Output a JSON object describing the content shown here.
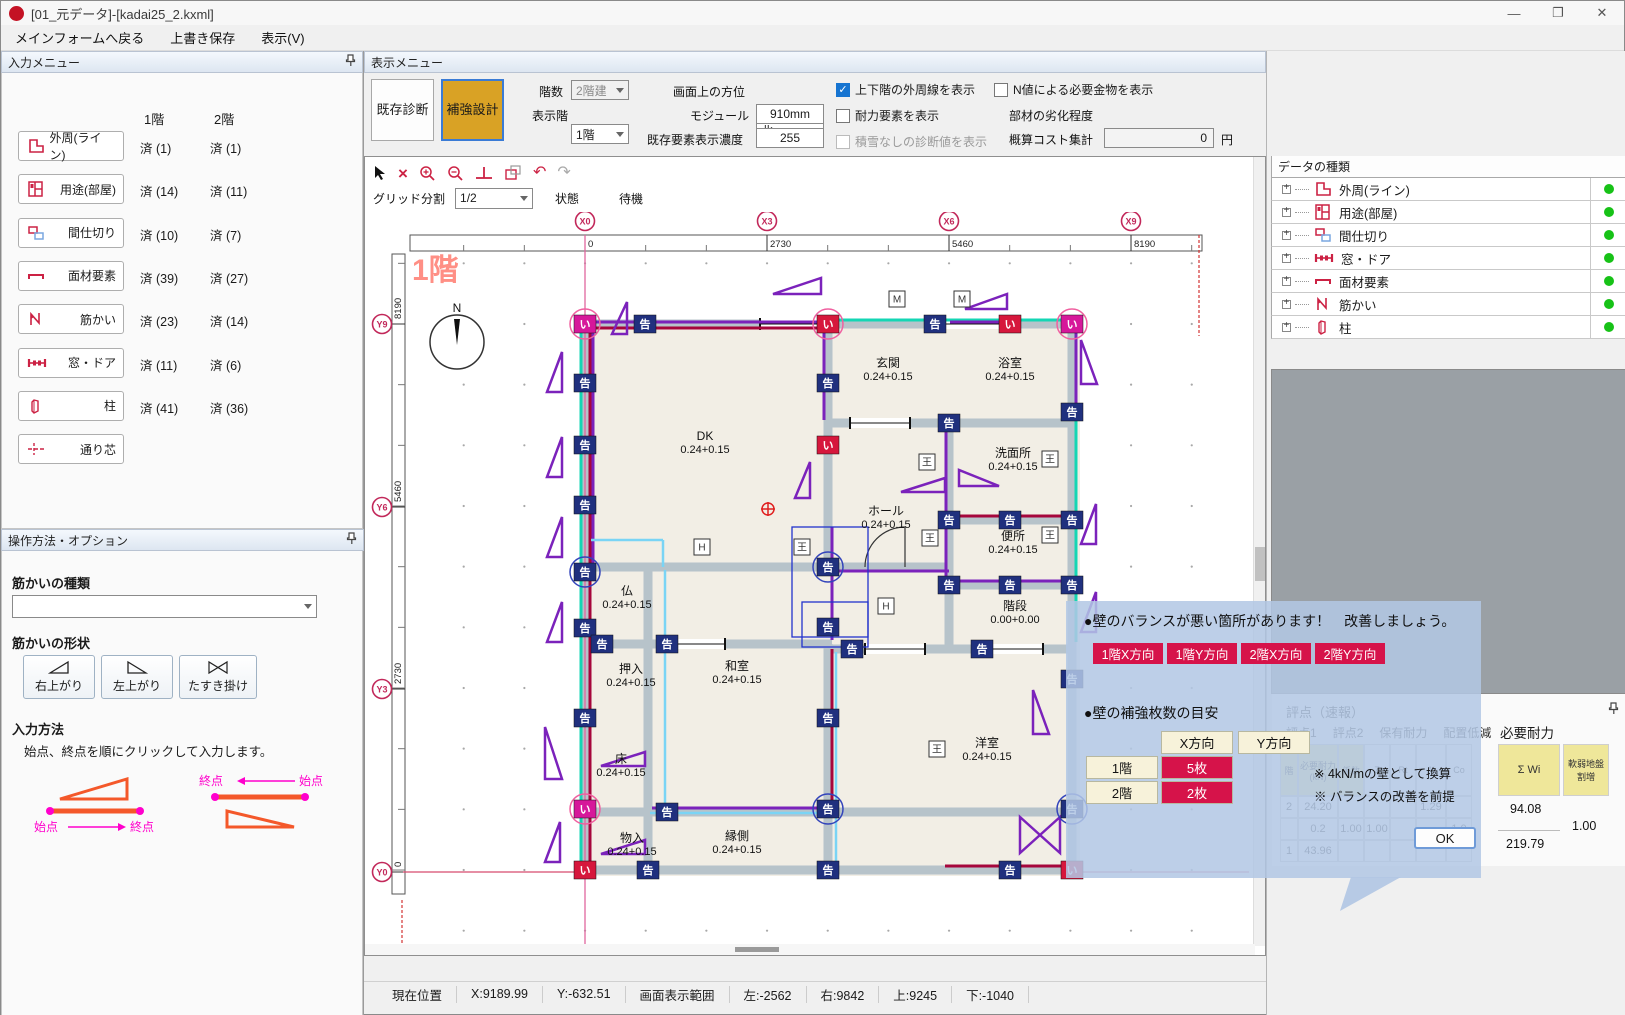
{
  "window": {
    "title": "[01_元データ]-[kadai25_2.kxml]",
    "minimize": "—",
    "maximize": "❐",
    "close": "✕"
  },
  "menu": {
    "items": [
      "メインフォームへ戻る",
      "上書き保存",
      "表示(V)"
    ]
  },
  "input_menu": {
    "title": "入力メニュー",
    "col1": "1階",
    "col2": "2階",
    "rows": [
      {
        "label": "外周(ライン)",
        "icon": "outline",
        "f1": "済 (1)",
        "f2": "済 (1)"
      },
      {
        "label": "用途(部屋)",
        "icon": "room",
        "f1": "済 (14)",
        "f2": "済 (11)"
      },
      {
        "label": "間仕切り",
        "icon": "partition",
        "f1": "済 (10)",
        "f2": "済 (7)"
      },
      {
        "label": "面材要素",
        "icon": "panel",
        "f1": "済 (39)",
        "f2": "済 (27)"
      },
      {
        "label": "筋かい",
        "icon": "brace",
        "f1": "済 (23)",
        "f2": "済 (14)"
      },
      {
        "label": "窓・ドア",
        "icon": "windoor",
        "f1": "済 (11)",
        "f2": "済 (6)"
      },
      {
        "label": "柱",
        "icon": "column",
        "f1": "済 (41)",
        "f2": "済 (36)"
      },
      {
        "label": "通り芯",
        "icon": "gridline",
        "f1": "",
        "f2": ""
      }
    ]
  },
  "options_panel": {
    "title": "操作方法・オプション",
    "type_label": "筋かいの種類",
    "shape_label": "筋かいの形状",
    "shapes": [
      "右上がり",
      "左上がり",
      "たすき掛け"
    ],
    "method_label": "入力方法",
    "method_text": "始点、終点を順にクリックして入力します。",
    "diag_start": "始点",
    "diag_end": "終点"
  },
  "display_menu": {
    "title": "表示メニュー",
    "buttons": [
      {
        "label": "既存診断"
      },
      {
        "label": "補強設計"
      }
    ],
    "floors_label": "階数",
    "floors_value": "2階建",
    "shown_floor_label": "表示階",
    "shown_floor_value": "1階",
    "direction_label": "画面上の方位",
    "direction_value": "北",
    "module_label": "モジュール",
    "module_value": "910mm",
    "density_label": "既存要素表示濃度",
    "density_value": "255",
    "checkboxes": [
      {
        "label": "上下階の外周線を表示",
        "checked": true,
        "disabled": false
      },
      {
        "label": "耐力要素を表示",
        "checked": false,
        "disabled": false
      },
      {
        "label": "積雪なしの診断値を表示",
        "checked": false,
        "disabled": true
      },
      {
        "label": "N値による必要金物を表示",
        "checked": false,
        "disabled": false
      }
    ],
    "degrade_label": "部材の劣化程度",
    "degrade_value": "①劣化が認められない",
    "cost_label": "概算コスト集計",
    "cost_value": "0",
    "cost_unit": "円"
  },
  "canvas": {
    "grid_label": "グリッド分割",
    "grid_value": "1/2",
    "state_label": "状態",
    "state_value": "待機",
    "floor_label": "1階",
    "compass": "N",
    "x_axis": [
      {
        "id": "X0",
        "v": "0",
        "p": 220
      },
      {
        "id": "X3",
        "v": "2730",
        "p": 402
      },
      {
        "id": "X6",
        "v": "5460",
        "p": 584
      },
      {
        "id": "X9",
        "v": "8190",
        "p": 766
      }
    ],
    "y_axis": [
      {
        "id": "Y9",
        "v": "8190",
        "p": 112
      },
      {
        "id": "Y6",
        "v": "5460",
        "p": 295
      },
      {
        "id": "Y3",
        "v": "2730",
        "p": 477
      },
      {
        "id": "Y0",
        "v": "0",
        "p": 660
      }
    ],
    "rooms": [
      {
        "n": "DK",
        "c": "0.24+0.15",
        "x": 340,
        "y": 228
      },
      {
        "n": "玄関",
        "c": "0.24+0.15",
        "x": 523,
        "y": 155
      },
      {
        "n": "浴室",
        "c": "0.24+0.15",
        "x": 645,
        "y": 155
      },
      {
        "n": "洗面所",
        "c": "0.24+0.15",
        "x": 648,
        "y": 245
      },
      {
        "n": "ホール",
        "c": "0.24+0.15",
        "x": 521,
        "y": 303
      },
      {
        "n": "便所",
        "c": "0.24+0.15",
        "x": 648,
        "y": 328
      },
      {
        "n": "階段",
        "c": "0.00+0.00",
        "x": 650,
        "y": 398
      },
      {
        "n": "仏",
        "c": "0.24+0.15",
        "x": 262,
        "y": 383
      },
      {
        "n": "押入",
        "c": "0.24+0.15",
        "x": 266,
        "y": 461
      },
      {
        "n": "和室",
        "c": "0.24+0.15",
        "x": 372,
        "y": 458
      },
      {
        "n": "床",
        "c": "0.24+0.15",
        "x": 256,
        "y": 551
      },
      {
        "n": "洋室",
        "c": "0.24+0.15",
        "x": 622,
        "y": 535
      },
      {
        "n": "物入",
        "c": "0.24+0.15",
        "x": 267,
        "y": 630
      },
      {
        "n": "縁側",
        "c": "0.24+0.15",
        "x": 372,
        "y": 628
      }
    ],
    "badges": [
      {
        "x": 220,
        "y": 112,
        "t": "い",
        "c": "#d6179a",
        "r": "pink"
      },
      {
        "x": 280,
        "y": 112,
        "t": "告"
      },
      {
        "x": 463,
        "y": 112,
        "t": "い",
        "c": "#d6173c",
        "r": "pink"
      },
      {
        "x": 570,
        "y": 112,
        "t": "告"
      },
      {
        "x": 645,
        "y": 112,
        "t": "い",
        "c": "#d6173c"
      },
      {
        "x": 707,
        "y": 112,
        "t": "い",
        "c": "#d6179a",
        "r": "pink"
      },
      {
        "x": 220,
        "y": 171,
        "t": "告"
      },
      {
        "x": 220,
        "y": 233,
        "t": "告"
      },
      {
        "x": 220,
        "y": 293,
        "t": "告"
      },
      {
        "x": 220,
        "y": 360,
        "t": "告",
        "r": "blue"
      },
      {
        "x": 220,
        "y": 416,
        "t": "告"
      },
      {
        "x": 220,
        "y": 506,
        "t": "告"
      },
      {
        "x": 220,
        "y": 597,
        "t": "い",
        "c": "#d6179a",
        "r": "pink"
      },
      {
        "x": 220,
        "y": 658,
        "t": "い",
        "c": "#d6173c"
      },
      {
        "x": 463,
        "y": 171,
        "t": "告"
      },
      {
        "x": 463,
        "y": 233,
        "t": "い",
        "c": "#d6173c"
      },
      {
        "x": 463,
        "y": 355,
        "t": "告",
        "r": "blue"
      },
      {
        "x": 463,
        "y": 415,
        "t": "告"
      },
      {
        "x": 463,
        "y": 506,
        "t": "告"
      },
      {
        "x": 463,
        "y": 597,
        "t": "告",
        "r": "blue"
      },
      {
        "x": 463,
        "y": 658,
        "t": "告"
      },
      {
        "x": 584,
        "y": 211,
        "t": "告"
      },
      {
        "x": 584,
        "y": 308,
        "t": "告"
      },
      {
        "x": 645,
        "y": 308,
        "t": "告"
      },
      {
        "x": 707,
        "y": 308,
        "t": "告"
      },
      {
        "x": 584,
        "y": 373,
        "t": "告"
      },
      {
        "x": 645,
        "y": 373,
        "t": "告"
      },
      {
        "x": 707,
        "y": 373,
        "t": "告"
      },
      {
        "x": 707,
        "y": 200,
        "t": "告"
      },
      {
        "x": 707,
        "y": 467,
        "t": "告"
      },
      {
        "x": 707,
        "y": 597,
        "t": "告",
        "r": "blue"
      },
      {
        "x": 237,
        "y": 432,
        "t": "告"
      },
      {
        "x": 302,
        "y": 432,
        "t": "告"
      },
      {
        "x": 487,
        "y": 437,
        "t": "告"
      },
      {
        "x": 617,
        "y": 437,
        "t": "告"
      },
      {
        "x": 302,
        "y": 600,
        "t": "告"
      },
      {
        "x": 283,
        "y": 658,
        "t": "告"
      },
      {
        "x": 645,
        "y": 658,
        "t": "告"
      },
      {
        "x": 707,
        "y": 658,
        "t": "い",
        "c": "#d6173c"
      }
    ],
    "boxes": [
      {
        "x": 532,
        "y": 87,
        "t": "M"
      },
      {
        "x": 597,
        "y": 87,
        "t": "M"
      },
      {
        "x": 337,
        "y": 335,
        "t": "H"
      },
      {
        "x": 521,
        "y": 394,
        "t": "H"
      },
      {
        "x": 437,
        "y": 335,
        "t": "王"
      },
      {
        "x": 562,
        "y": 250,
        "t": "王"
      },
      {
        "x": 565,
        "y": 326,
        "t": "王"
      },
      {
        "x": 685,
        "y": 247,
        "t": "王"
      },
      {
        "x": 685,
        "y": 323,
        "t": "王"
      },
      {
        "x": 572,
        "y": 537,
        "t": "王"
      }
    ],
    "wallsH": [
      [
        112,
        216,
        711
      ],
      [
        211,
        459,
        711
      ],
      [
        308,
        580,
        711
      ],
      [
        373,
        580,
        711
      ],
      [
        355,
        216,
        588
      ],
      [
        432,
        216,
        467
      ],
      [
        437,
        459,
        711
      ],
      [
        600,
        216,
        711
      ],
      [
        658,
        216,
        711
      ]
    ],
    "wallsV": [
      [
        220,
        108,
        662
      ],
      [
        463,
        108,
        355
      ],
      [
        463,
        432,
        662
      ],
      [
        584,
        211,
        437
      ],
      [
        707,
        108,
        662
      ],
      [
        283,
        355,
        662
      ]
    ],
    "gaps": [
      [
        112,
        395,
        458
      ],
      [
        112,
        575,
        640
      ],
      [
        211,
        485,
        545
      ],
      [
        437,
        500,
        560
      ],
      [
        437,
        620,
        678
      ],
      [
        432,
        295,
        360
      ]
    ],
    "teal": [
      [
        216,
        112,
        216,
        660
      ],
      [
        463,
        108,
        711,
        108
      ],
      [
        711,
        112,
        711,
        430
      ]
    ],
    "crimson": [
      [
        225,
        116,
        225,
        658
      ],
      [
        220,
        116,
        460,
        116
      ],
      [
        580,
        304,
        711,
        304
      ],
      [
        467,
        437,
        467,
        597
      ],
      [
        580,
        654,
        711,
        654
      ]
    ],
    "purple": [
      [
        220,
        110,
        460,
        110
      ],
      [
        228,
        120,
        228,
        352
      ],
      [
        459,
        116,
        459,
        208
      ],
      [
        463,
        359,
        584,
        359
      ],
      [
        467,
        315,
        467,
        428
      ],
      [
        581,
        215,
        581,
        370
      ],
      [
        584,
        369,
        707,
        369
      ],
      [
        287,
        596,
        460,
        596
      ],
      [
        585,
        110,
        640,
        110
      ],
      [
        711,
        116,
        711,
        200
      ]
    ],
    "cyan": [
      [
        300,
        358,
        300,
        597
      ],
      [
        471,
        440,
        471,
        655
      ],
      [
        285,
        601,
        460,
        601
      ],
      [
        226,
        328,
        298,
        328
      ],
      [
        298,
        328,
        298,
        355
      ]
    ],
    "triangles": [
      [
        408,
        66,
        48,
        16,
        "r"
      ],
      [
        600,
        82,
        42,
        15,
        "r"
      ],
      [
        247,
        90,
        15,
        32,
        "v"
      ],
      [
        182,
        140,
        15,
        40,
        "v"
      ],
      [
        182,
        225,
        15,
        40,
        "v"
      ],
      [
        182,
        305,
        15,
        40,
        "v"
      ],
      [
        182,
        390,
        15,
        40,
        "v"
      ],
      [
        180,
        515,
        17,
        52,
        "v2"
      ],
      [
        180,
        610,
        15,
        40,
        "v"
      ],
      [
        536,
        266,
        44,
        14,
        "r"
      ],
      [
        594,
        258,
        40,
        16,
        "l"
      ],
      [
        716,
        128,
        16,
        44,
        "v2"
      ],
      [
        716,
        292,
        15,
        40,
        "v"
      ],
      [
        716,
        380,
        15,
        40,
        "v"
      ],
      [
        668,
        478,
        16,
        44,
        "v2"
      ],
      [
        236,
        540,
        44,
        14,
        "r"
      ],
      [
        236,
        628,
        44,
        14,
        "r"
      ],
      [
        655,
        605,
        40,
        36,
        "x"
      ],
      [
        430,
        250,
        15,
        36,
        "v"
      ]
    ]
  },
  "data_list": {
    "title": "データリストビュー",
    "header": "データの種類",
    "items": [
      {
        "label": "外周(ライン)",
        "icon": "outline"
      },
      {
        "label": "用途(部屋)",
        "icon": "room"
      },
      {
        "label": "間仕切り",
        "icon": "partition"
      },
      {
        "label": "窓・ドア",
        "icon": "windoor"
      },
      {
        "label": "面材要素",
        "icon": "panel"
      },
      {
        "label": "筋かい",
        "icon": "brace"
      },
      {
        "label": "柱",
        "icon": "column"
      }
    ]
  },
  "score_panel": {
    "title": "評点（速報）",
    "tabs": [
      "評点1",
      "評点2",
      "保有耐力",
      "配置低減"
    ],
    "col_headers": [
      "階",
      "必要耐力(kN)",
      "係数",
      "Z",
      "Rt",
      "Ai",
      "Co"
    ],
    "rows": [
      [
        "2",
        "24.20",
        "",
        "",
        "",
        "1.29",
        ""
      ],
      [
        "",
        "0.2",
        "1.00",
        "1.00",
        "",
        "",
        "1.0"
      ],
      [
        "1",
        "43.96",
        "",
        "",
        "",
        "",
        ""
      ]
    ],
    "req_title": "必要耐力",
    "req_col1": "Σ Wi",
    "req_col2": "軟弱地盤割増",
    "req_v_top": "94.08",
    "req_v_mid": "1.00",
    "req_v_bottom": "219.79"
  },
  "popup": {
    "line1": "●壁のバランスが悪い箇所があります！　改善しましょう。",
    "badges": [
      "1階X方向",
      "1階Y方向",
      "2階X方向",
      "2階Y方向"
    ],
    "line2": "●壁の補強枚数の目安",
    "col_x": "X方向",
    "col_y": "Y方向",
    "row1_label": "1階",
    "row1_value": "5枚",
    "row2_label": "2階",
    "row2_value": "2枚",
    "notes": [
      "※ 4kN/mの壁として換算",
      "※ バランスの改善を前提"
    ],
    "ok": "OK",
    "accent": "#d6134a",
    "cream": "#f7f2da"
  },
  "status_bar": {
    "items": [
      "現在位置",
      "X:9189.99",
      "Y:-632.51",
      "画面表示範囲",
      "左:-2562",
      "右:9842",
      "上:9245",
      "下:-1040"
    ]
  },
  "mascot": {
    "tag": "ゑ"
  }
}
